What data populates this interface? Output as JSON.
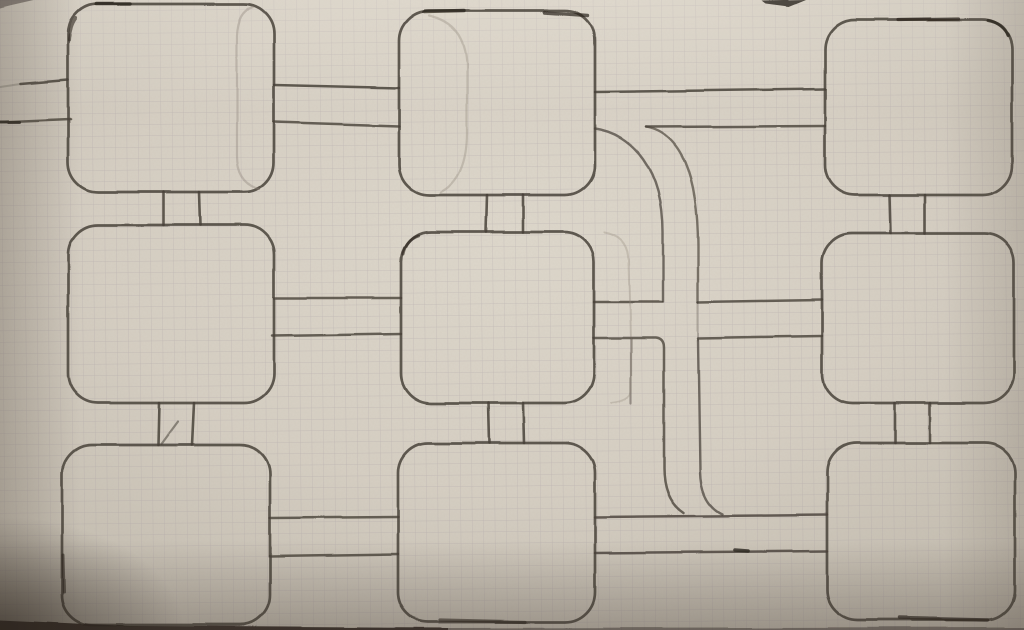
{
  "diagram": {
    "description": "Photograph of a hand-drawn pencil diagram on squared graph paper: a 3x3 grid of rounded squares joined by pairs of parallel connector lines, with two large curved branch lines sweeping from the top-middle box down to the bottom-right box",
    "colors": {
      "paper": "#d6cfc3",
      "paper_light": "#ded8cc",
      "paper_shadow": "#b9b2a5",
      "grid": "#9b929b",
      "pencil": "#49423a",
      "pencil_dark": "#2b251e",
      "ghost": "#8e8478"
    },
    "grid_spacing": 11.4,
    "grid_tilt_deg": -0.5,
    "nodes": [
      {
        "id": "box-top-left",
        "x": 68,
        "y": 4,
        "w": 206,
        "h": 188,
        "r": 30
      },
      {
        "id": "box-top-middle",
        "x": 399,
        "y": 11,
        "w": 196,
        "h": 184,
        "r": 30
      },
      {
        "id": "box-top-right",
        "x": 825,
        "y": 20,
        "w": 187,
        "h": 175,
        "r": 30
      },
      {
        "id": "box-middle-left",
        "x": 68,
        "y": 225,
        "w": 206,
        "h": 178,
        "r": 30
      },
      {
        "id": "box-middle-middle",
        "x": 401,
        "y": 232,
        "w": 193,
        "h": 171,
        "r": 30
      },
      {
        "id": "box-middle-right",
        "x": 822,
        "y": 233,
        "w": 192,
        "h": 170,
        "r": 30
      },
      {
        "id": "box-bottom-left",
        "x": 62,
        "y": 445,
        "w": 208,
        "h": 180,
        "r": 30
      },
      {
        "id": "box-bottom-middle",
        "x": 398,
        "y": 443,
        "w": 197,
        "h": 179,
        "r": 30
      },
      {
        "id": "box-bottom-right",
        "x": 827,
        "y": 443,
        "w": 188,
        "h": 177,
        "r": 30
      }
    ],
    "strokes": [
      {
        "name": "left-entry-line-upper",
        "d": "M 21 84 L 68 80",
        "w": 2.6,
        "o": 0.85
      },
      {
        "name": "left-entry-upper-faint-lead",
        "d": "M 0 87 L 21 84",
        "w": 2.0,
        "o": 0.25
      },
      {
        "name": "left-entry-line-lower",
        "d": "M 0 122 L 70 119",
        "w": 2.6,
        "o": 0.8
      },
      {
        "name": "tl-tm-link-upper",
        "d": "M 274 85 L 399 88",
        "w": 2.5,
        "o": 0.85
      },
      {
        "name": "tl-tm-link-lower",
        "d": "M 274 122 L 399 126",
        "w": 2.5,
        "o": 0.8
      },
      {
        "name": "tm-tr-link-upper",
        "d": "M 595 92 L 825 89",
        "w": 2.5,
        "o": 0.85
      },
      {
        "name": "tm-tr-link-lower",
        "d": "M 646 127 L 825 126",
        "w": 2.5,
        "o": 0.8
      },
      {
        "name": "curve-inner-branch",
        "d": "M 595 129 C 633 134 663 170 663 232 L 663 302",
        "w": 2.4,
        "o": 0.72
      },
      {
        "name": "curve-outer-branch",
        "d": "M 646 127 C 681 133 698 176 698 246 L 698 302",
        "w": 2.4,
        "o": 0.68
      },
      {
        "name": "ml-mm-link-upper",
        "d": "M 274 298 L 401 298",
        "w": 2.5,
        "o": 0.8
      },
      {
        "name": "ml-mm-link-lower",
        "d": "M 272 336 L 401 334",
        "w": 2.5,
        "o": 0.8
      },
      {
        "name": "mm-junction-link-upper",
        "d": "M 594 302 L 662 302",
        "w": 2.5,
        "o": 0.8
      },
      {
        "name": "junction-mr-link-upper",
        "d": "M 698 302 L 822 300",
        "w": 2.5,
        "o": 0.8
      },
      {
        "name": "mm-elbow-to-bottom",
        "d": "M 594 338 L 656 338 Q 664 339 664 348 L 664 468 Q 664 500 684 513",
        "w": 2.5,
        "o": 0.78
      },
      {
        "name": "junction-mr-link-lower",
        "d": "M 698 338 L 822 336",
        "w": 2.5,
        "o": 0.8
      },
      {
        "name": "outer-vertical-upper-gap",
        "d": "M 698 302 L 698 340",
        "w": 2.0,
        "o": 0.3
      },
      {
        "name": "outer-vertical-to-bottom",
        "d": "M 698 340 L 700 472 Q 701 504 722 514",
        "w": 2.4,
        "o": 0.72
      },
      {
        "name": "mid-branch-vertical",
        "d": "M 631 338 L 631 404",
        "w": 2.2,
        "o": 0.45
      },
      {
        "name": "bl-bm-link-upper",
        "d": "M 270 518 L 398 517",
        "w": 2.5,
        "o": 0.8
      },
      {
        "name": "bl-bm-link-lower",
        "d": "M 270 556 L 398 554",
        "w": 2.5,
        "o": 0.8
      },
      {
        "name": "bm-br-link-upper",
        "d": "M 595 517 L 827 515",
        "w": 2.5,
        "o": 0.82
      },
      {
        "name": "bm-br-link-lower",
        "d": "M 595 553 L 827 551",
        "w": 2.5,
        "o": 0.82
      },
      {
        "name": "tl-ml-stub-left",
        "d": "M 163 192 L 163 225",
        "w": 2.6,
        "o": 0.85
      },
      {
        "name": "tl-ml-stub-right",
        "d": "M 199 192 L 200 225",
        "w": 2.6,
        "o": 0.85
      },
      {
        "name": "tm-mm-stub-left",
        "d": "M 487 195 L 486 232",
        "w": 2.6,
        "o": 0.85
      },
      {
        "name": "tm-mm-stub-right",
        "d": "M 523 195 L 523 232",
        "w": 2.6,
        "o": 0.85
      },
      {
        "name": "tr-mr-stub-left",
        "d": "M 890 195 L 891 233",
        "w": 2.6,
        "o": 0.85
      },
      {
        "name": "tr-mr-stub-right",
        "d": "M 925 195 L 925 233",
        "w": 2.6,
        "o": 0.85
      },
      {
        "name": "ml-bl-stub-left",
        "d": "M 159 403 L 158 445",
        "w": 2.6,
        "o": 0.85
      },
      {
        "name": "ml-bl-stub-right",
        "d": "M 194 403 L 192 445",
        "w": 2.6,
        "o": 0.85
      },
      {
        "name": "ml-bl-slip-stroke",
        "d": "M 161 444 L 178 421",
        "w": 2.2,
        "o": 0.55
      },
      {
        "name": "mm-bm-stub-left",
        "d": "M 488 403 L 489 443",
        "w": 2.6,
        "o": 0.85
      },
      {
        "name": "mm-bm-stub-right",
        "d": "M 523 403 L 524 443",
        "w": 2.6,
        "o": 0.85
      },
      {
        "name": "mr-br-stub-left",
        "d": "M 895 403 L 895 443",
        "w": 2.6,
        "o": 0.85
      },
      {
        "name": "mr-br-stub-right",
        "d": "M 930 403 L 930 443",
        "w": 2.6,
        "o": 0.85
      },
      {
        "name": "ghost-tl-inner-edge",
        "d": "M 253 7 Q 238 11 237 36 L 237 156 Q 237 182 259 189",
        "w": 2.2,
        "o": 0.38
      },
      {
        "name": "ghost-tm-inner-edge",
        "d": "M 429 16 Q 466 24 467 66 L 467 132 Q 467 178 441 192",
        "w": 2.2,
        "o": 0.34
      },
      {
        "name": "ghost-mm-outer-edge-top",
        "d": "M 604 232 Q 628 236 629 260 L 631 338",
        "w": 2.0,
        "o": 0.3
      },
      {
        "name": "ghost-mm-outer-edge-bottom",
        "d": "M 631 340 L 631 392 Q 630 401 611 403",
        "w": 2.0,
        "o": 0.3
      }
    ],
    "marks": [
      {
        "name": "dark-dash-tl-top",
        "d": "M 96 4 L 130 4",
        "w": 3.4,
        "o": 0.75
      },
      {
        "name": "dark-dash-tl-corner",
        "d": "M 76 18 Q 70 26 69 40",
        "w": 3.0,
        "o": 0.6
      },
      {
        "name": "dark-dash-tm-top-left",
        "d": "M 424 12 L 464 11",
        "w": 3.4,
        "o": 0.75
      },
      {
        "name": "dark-dash-tm-top-right",
        "d": "M 545 13 L 588 16",
        "w": 3.4,
        "o": 0.7
      },
      {
        "name": "dark-dash-tr-top",
        "d": "M 898 20 L 958 19",
        "w": 3.2,
        "o": 0.7
      },
      {
        "name": "dark-dash-tr-corner",
        "d": "M 988 21 Q 1004 24 1008 36",
        "w": 3.0,
        "o": 0.75
      },
      {
        "name": "dark-dash-mm-corner",
        "d": "M 418 236 Q 406 240 403 254",
        "w": 3.0,
        "o": 0.6
      },
      {
        "name": "dark-dash-left-entry",
        "d": "M 0 122 L 20 122",
        "w": 3.0,
        "o": 0.8
      },
      {
        "name": "dark-blob-bm-br-line",
        "d": "M 735 550 L 748 551",
        "w": 3.6,
        "o": 0.8
      },
      {
        "name": "dark-dash-bm-bottom",
        "d": "M 440 620 L 525 622",
        "w": 3.2,
        "o": 0.6
      },
      {
        "name": "dark-dash-br-bottom",
        "d": "M 900 618 L 988 620",
        "w": 3.4,
        "o": 0.7
      },
      {
        "name": "dark-dash-bl-left",
        "d": "M 63 555 L 64 592",
        "w": 3.0,
        "o": 0.6
      },
      {
        "name": "photo-top-edge-wedge",
        "d": "M 762 1 L 806 0 L 789 7 L 766 4 Z",
        "fill": true,
        "o": 0.8
      },
      {
        "name": "photo-top-left-nick",
        "d": "M 0 0 L 34 0 L 12 5 L 0 8 Z",
        "fill": true,
        "o": 0.45
      },
      {
        "name": "photo-bottom-strip-left",
        "d": "M 0 620 L 130 626 L 448 628 L 448 631 L 0 631 Z",
        "fill": true,
        "o": 0.9
      },
      {
        "name": "photo-bottom-strip-right",
        "d": "M 448 628 L 1025 627 L 1025 631 L 448 631 Z",
        "fill": true,
        "o": 0.45
      }
    ]
  }
}
